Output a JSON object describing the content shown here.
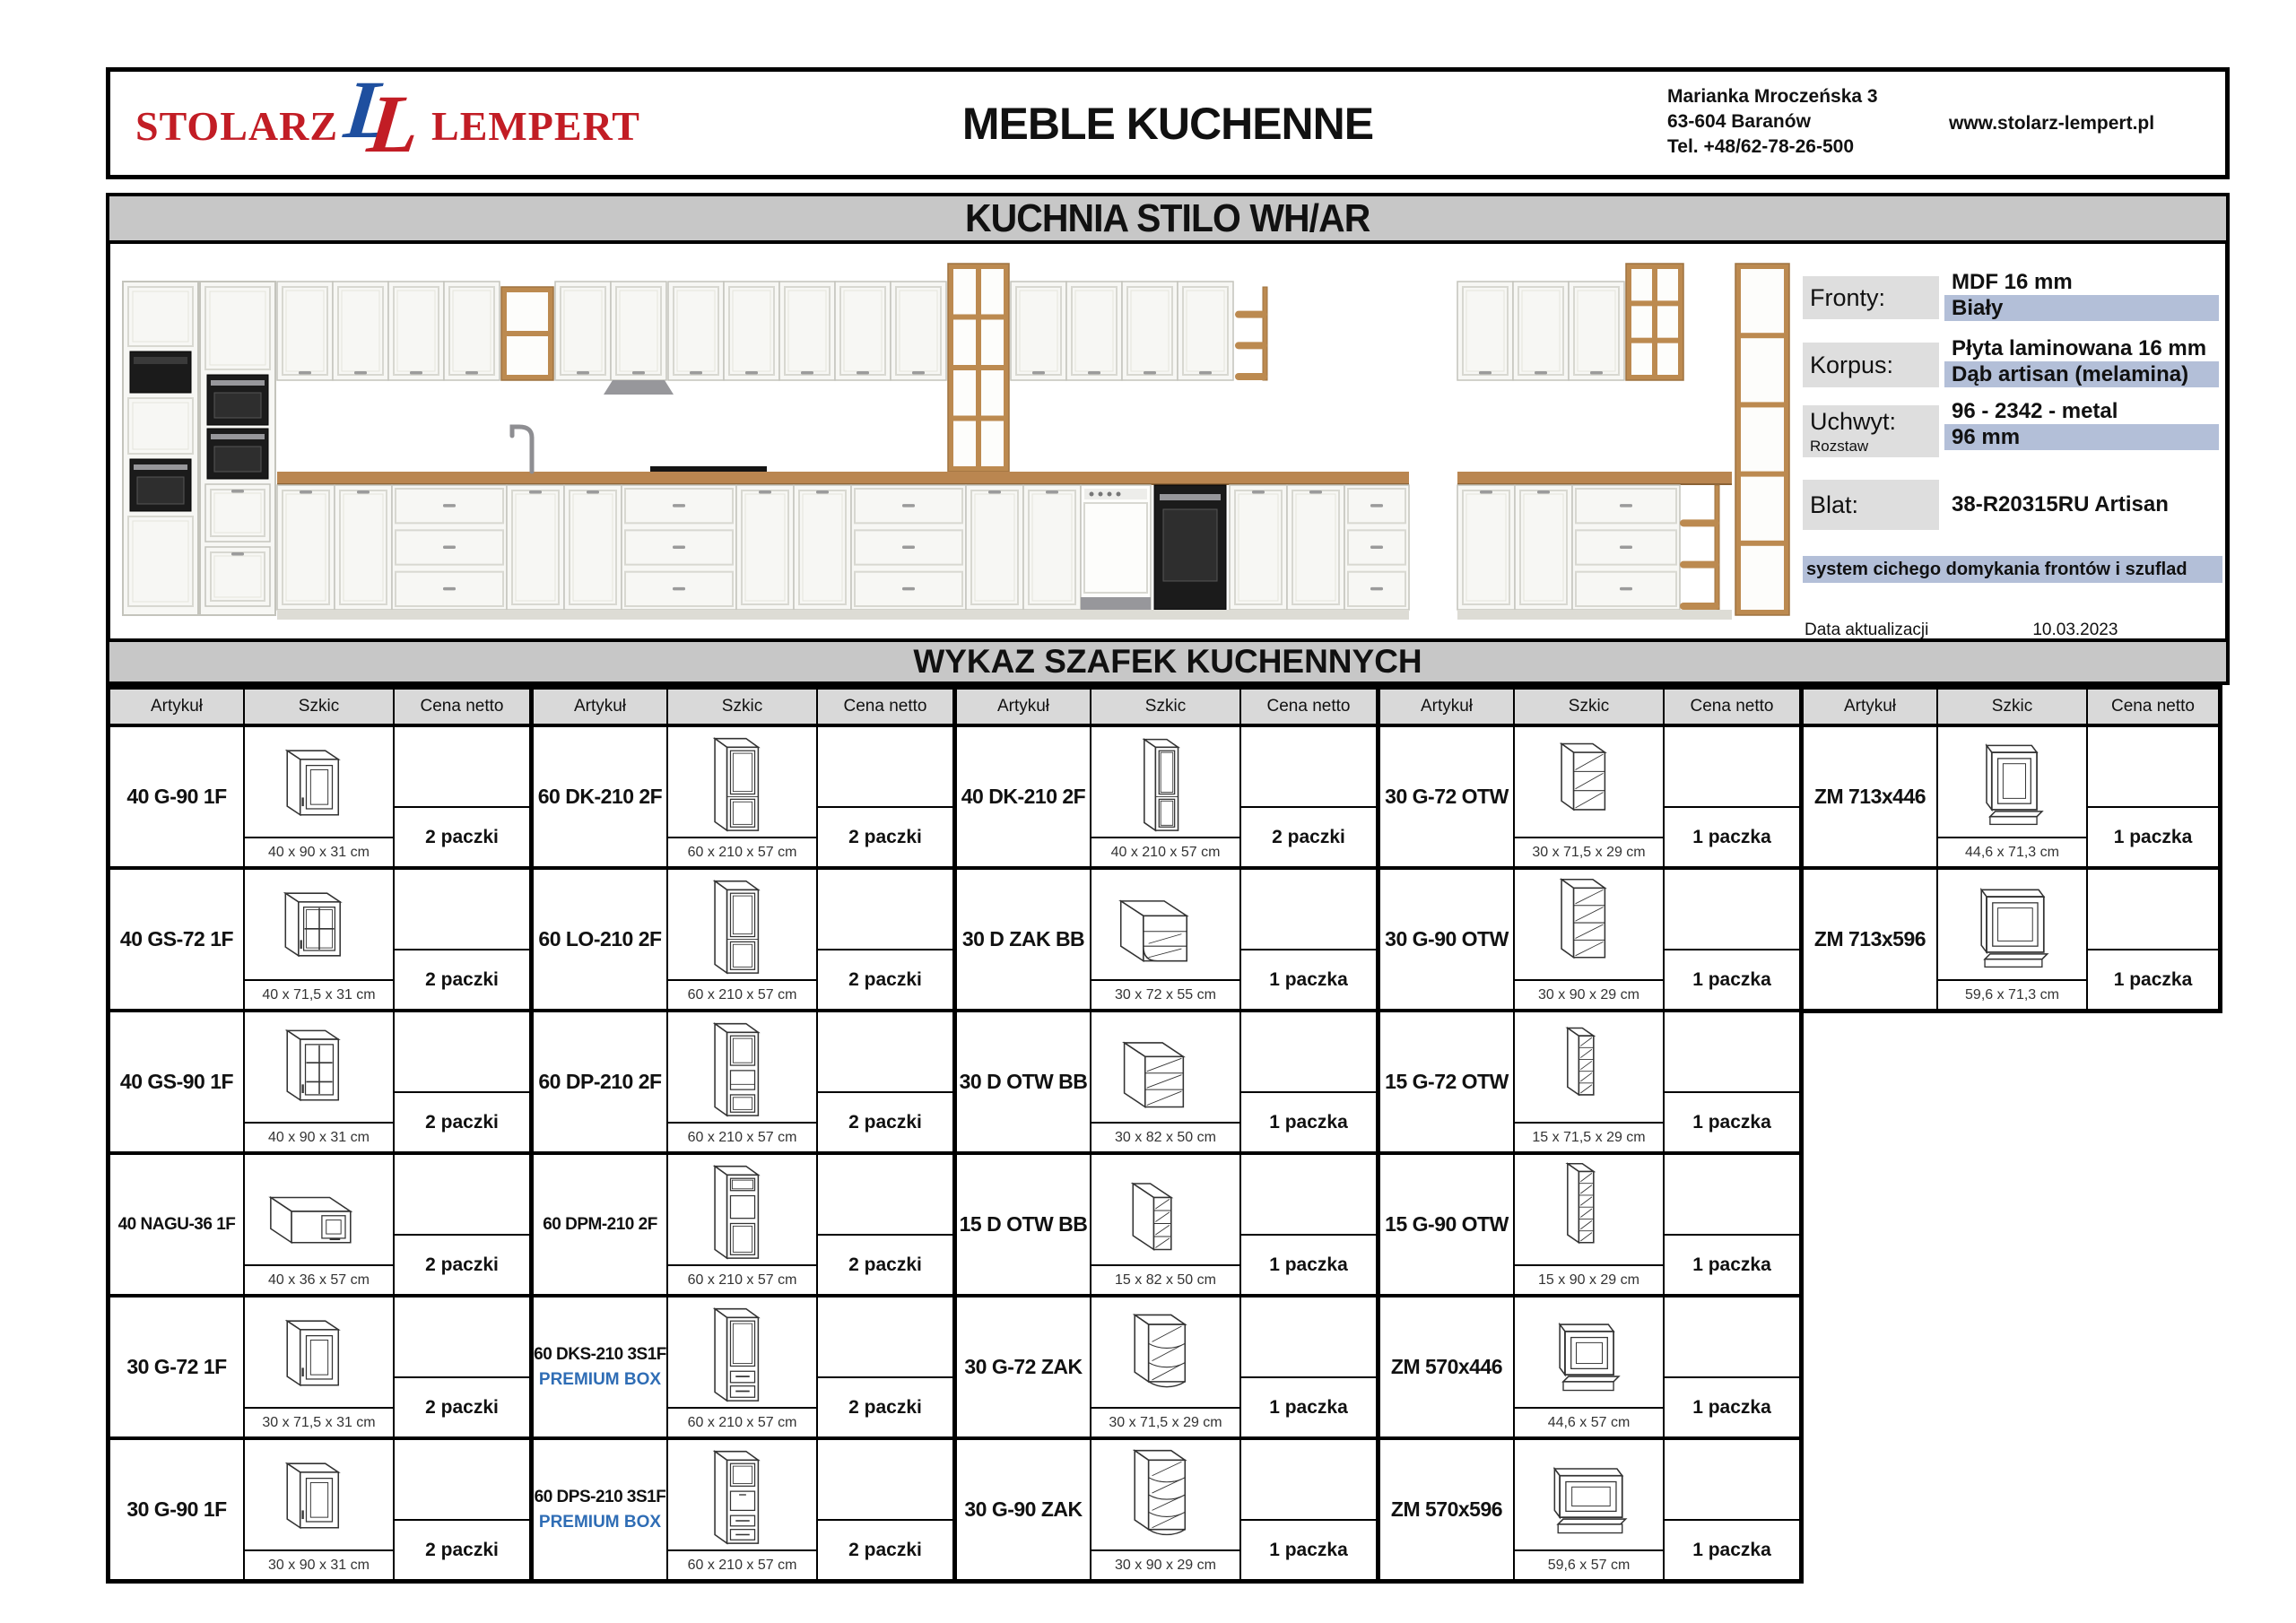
{
  "header": {
    "logo_left": "STOLARZ",
    "logo_right": "LEMPERT",
    "logo_monogram": "LL",
    "title": "MEBLE KUCHENNE",
    "address": [
      "Marianka Mroczeńska 3",
      "63-604 Baranów",
      "Tel. +48/62-78-26-500"
    ],
    "website": "www.stolarz-lempert.pl"
  },
  "product_banner": "KUCHNIA STILO WH/AR",
  "specs": {
    "rows": [
      {
        "label": "Fronty:",
        "sub": "",
        "lines": [
          {
            "t": "MDF 16 mm",
            "hl": false
          },
          {
            "t": "Biały",
            "hl": true
          }
        ]
      },
      {
        "label": "Korpus:",
        "sub": "",
        "lines": [
          {
            "t": "Płyta laminowana 16 mm",
            "hl": false
          },
          {
            "t": "Dąb artisan (melamina)",
            "hl": true
          }
        ]
      },
      {
        "label": "Uchwyt:",
        "sub": "Rozstaw",
        "lines": [
          {
            "t": "96 - 2342 - metal",
            "hl": false
          },
          {
            "t": "96 mm",
            "hl": true
          }
        ]
      },
      {
        "label": "Blat:",
        "sub": "",
        "lines": [
          {
            "t": "38-R20315RU Artisan",
            "hl": false
          }
        ]
      }
    ],
    "note": "system cichego domykania frontów i szuflad",
    "updated_label": "Data aktualizacji",
    "updated_value": "10.03.2023"
  },
  "table": {
    "title": "WYKAZ SZAFEK KUCHENNYCH",
    "col_headers": [
      "Artykuł",
      "Szkic",
      "Cena netto"
    ],
    "groups": [
      {
        "rows": [
          {
            "article": "40 G-90 1F",
            "premium": "",
            "sketch": "wall-door",
            "dims": "40 x 90 x 31 cm",
            "qty": "2 paczki"
          },
          {
            "article": "40 GS-72 1F",
            "premium": "",
            "sketch": "wall-glass-4",
            "dims": "40 x 71,5 x 31 cm",
            "qty": "2 paczki"
          },
          {
            "article": "40 GS-90 1F",
            "premium": "",
            "sketch": "wall-glass-6",
            "dims": "40 x 90 x 31 cm",
            "qty": "2 paczki"
          },
          {
            "article": "40 NAGU-36 1F",
            "premium": "",
            "sketch": "wall-horizontal",
            "dims": "40 x 36 x 57 cm",
            "qty": "2 paczki"
          },
          {
            "article": "30 G-72 1F",
            "premium": "",
            "sketch": "wall-door",
            "dims": "30 x 71,5 x 31 cm",
            "qty": "2 paczki"
          },
          {
            "article": "30 G-90 1F",
            "premium": "",
            "sketch": "wall-door",
            "dims": "30 x 90 x 31 cm",
            "qty": "2 paczki"
          }
        ]
      },
      {
        "rows": [
          {
            "article": "60 DK-210 2F",
            "premium": "",
            "sketch": "tall-2door",
            "dims": "60 x 210 x 57 cm",
            "qty": "2 paczki"
          },
          {
            "article": "60 LO-210 2F",
            "premium": "",
            "sketch": "tall-2door",
            "dims": "60 x 210 x 57 cm",
            "qty": "2 paczki"
          },
          {
            "article": "60 DP-210 2F",
            "premium": "",
            "sketch": "tall-oven",
            "dims": "60 x 210 x 57 cm",
            "qty": "2 paczki"
          },
          {
            "article": "60 DPM-210 2F",
            "premium": "",
            "sketch": "tall-oven-micro",
            "dims": "60 x 210 x 57 cm",
            "qty": "2 paczki"
          },
          {
            "article": "60 DKS-210 3S1F",
            "premium": "PREMIUM BOX",
            "sketch": "tall-drawers",
            "dims": "60 x 210 x 57 cm",
            "qty": "2 paczki"
          },
          {
            "article": "60 DPS-210 3S1F",
            "premium": "PREMIUM BOX",
            "sketch": "tall-oven-drawers",
            "dims": "60 x 210 x 57 cm",
            "qty": "2 paczki"
          }
        ]
      },
      {
        "rows": [
          {
            "article": "40 DK-210 2F",
            "premium": "",
            "sketch": "tall-2door-narrow",
            "dims": "40 x 210 x 57 cm",
            "qty": "2 paczki"
          },
          {
            "article": "30 D ZAK BB",
            "premium": "",
            "sketch": "base-corner-open",
            "dims": "30 x 72 x 55 cm",
            "qty": "1 paczka"
          },
          {
            "article": "30 D OTW BB",
            "premium": "",
            "sketch": "base-open-shelf",
            "dims": "30 x 82 x 50 cm",
            "qty": "1 paczka"
          },
          {
            "article": "15 D OTW BB",
            "premium": "",
            "sketch": "base-open-shelf-narrow",
            "dims": "15 x 82 x 50 cm",
            "qty": "1 paczka"
          },
          {
            "article": "30 G-72 ZAK",
            "premium": "",
            "sketch": "wall-corner-shelf-3",
            "dims": "30 x 71,5 x 29 cm",
            "qty": "1 paczka"
          },
          {
            "article": "30 G-90 ZAK",
            "premium": "",
            "sketch": "wall-corner-shelf-4",
            "dims": "30 x 90 x 29 cm",
            "qty": "1 paczka"
          }
        ]
      },
      {
        "rows": [
          {
            "article": "30 G-72 OTW",
            "premium": "",
            "sketch": "wall-open-3",
            "dims": "30 x 71,5 x 29 cm",
            "qty": "1 paczka"
          },
          {
            "article": "30 G-90 OTW",
            "premium": "",
            "sketch": "wall-open-4",
            "dims": "30 x 90 x 29 cm",
            "qty": "1 paczka"
          },
          {
            "article": "15 G-72 OTW",
            "premium": "",
            "sketch": "wall-open-narrow-5",
            "dims": "15 x 71,5 x 29 cm",
            "qty": "1 paczka"
          },
          {
            "article": "15 G-90 OTW",
            "premium": "",
            "sketch": "wall-open-narrow-6",
            "dims": "15 x 90 x 29 cm",
            "qty": "1 paczka"
          },
          {
            "article": "ZM 570x446",
            "premium": "",
            "sketch": "end-panel-small",
            "dims": "44,6 x 57 cm",
            "qty": "1 paczka"
          },
          {
            "article": "ZM 570x596",
            "premium": "",
            "sketch": "end-panel-wide",
            "dims": "59,6 x 57 cm",
            "qty": "1 paczka"
          }
        ]
      },
      {
        "rows": [
          {
            "article": "ZM 713x446",
            "premium": "",
            "sketch": "end-panel-tall",
            "dims": "44,6 x 71,3 cm",
            "qty": "1 paczka"
          },
          {
            "article": "ZM 713x596",
            "premium": "",
            "sketch": "end-panel-tall-wide",
            "dims": "59,6 x 71,3 cm",
            "qty": "1 paczka"
          }
        ]
      }
    ]
  },
  "colors": {
    "logo_red": "#c21d25",
    "logo_blue": "#1e4f9f",
    "premium_blue": "#2f6db5",
    "highlight_blue": "#b3bfd8",
    "banner_gray": "#c7c7c7",
    "header_gray": "#d9d9d9",
    "wood": "#bc8a50"
  }
}
